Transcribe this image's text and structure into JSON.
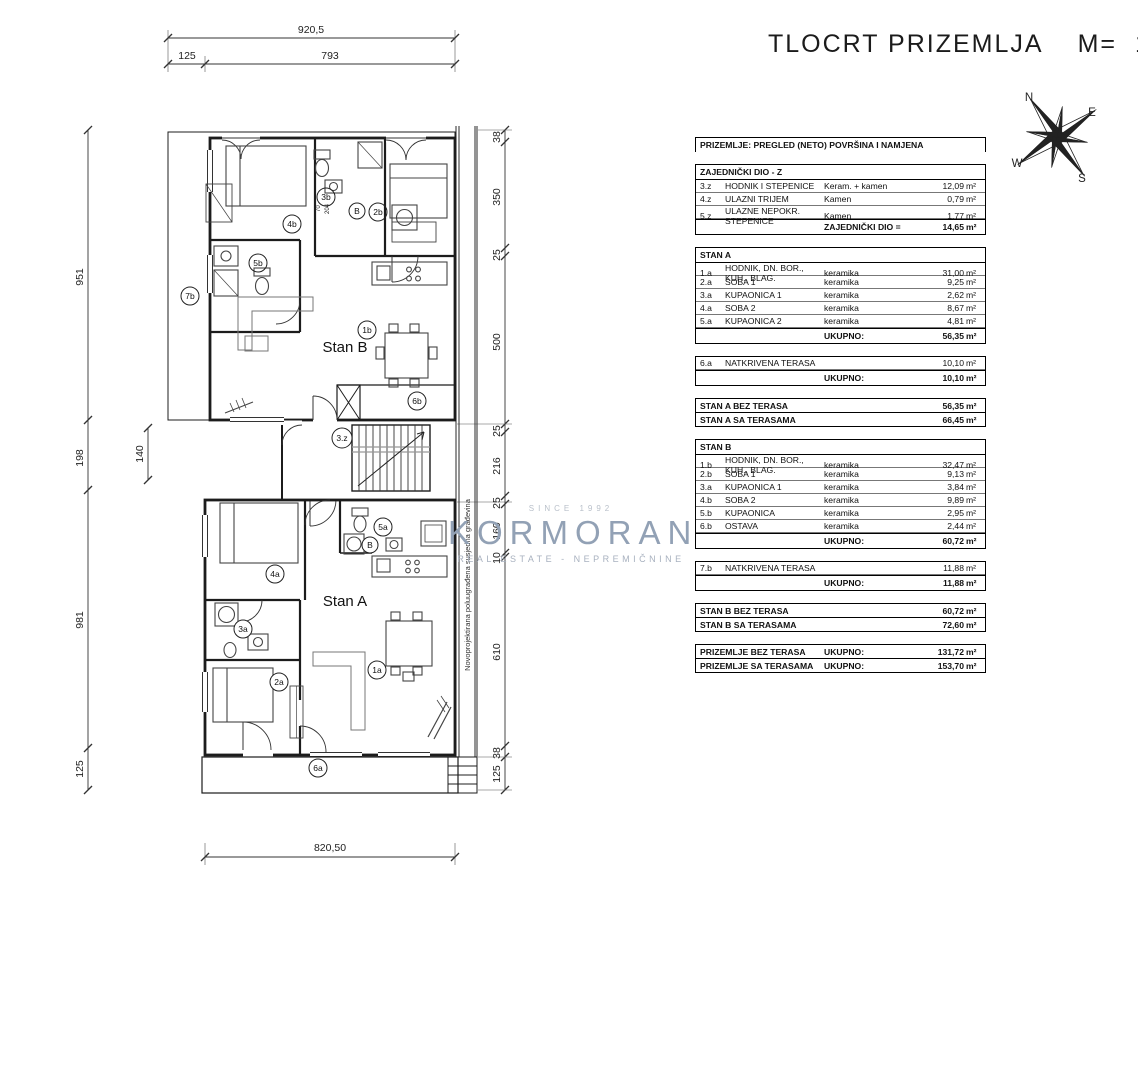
{
  "title": {
    "text": "TLOCRT PRIZEMLJA",
    "scale_label": "M=",
    "scale_value": "1:100"
  },
  "compass": {
    "n": "N",
    "e": "E",
    "s": "S",
    "w": "W"
  },
  "watermark": {
    "since": "SINCE 1992",
    "name": "KORMORAN",
    "subtitle": "REAL ESTATE - NEPREMIČNINE"
  },
  "plan": {
    "labels": {
      "stan_a": "Stan A",
      "stan_b": "Stan B",
      "side_note": "Novoprojektirana poluugrađena susjedna građevina"
    },
    "tags": {
      "t7b": "7b",
      "t4b": "4b",
      "t3b": "3b",
      "tB1": "B",
      "t2b": "2b",
      "t5b": "5b",
      "t1b": "1b",
      "t6b": "6b",
      "t3z": "3.z",
      "t4a": "4a",
      "t5a": "5a",
      "tB2": "B",
      "t3a": "3a",
      "t2a": "2a",
      "t1a": "1a",
      "t6a": "6a"
    },
    "inner_dims": {
      "d1": "70",
      "d2": "204"
    },
    "dims": {
      "top_total": "920,5",
      "top_left": "125",
      "top_right": "793",
      "bottom_total": "820,50",
      "left_1": "951",
      "left_2": "198",
      "left_2_inner": "140",
      "left_3": "981",
      "left_4": "125",
      "right_1": "38",
      "right_2": "350",
      "right_3": "25",
      "right_4": "500",
      "right_5": "25",
      "right_6": "216",
      "right_7": "25",
      "right_8": "160",
      "right_9": "10",
      "right_10": "610",
      "right_11": "38",
      "right_12": "125"
    }
  },
  "table": {
    "title": "PRIZEMLJE: PREGLED (NETO) POVRŠINA I NAMJENA",
    "unit": "m²",
    "sections": [
      {
        "header": "ZAJEDNIČKI DIO - Z",
        "rows": [
          {
            "code": "3.z",
            "name": "HODNIK I STEPENICE",
            "material": "Keram. + kamen",
            "value": "12,09"
          },
          {
            "code": "4.z",
            "name": "ULAZNI TRIJEM",
            "material": "Kamen",
            "value": "0,79"
          },
          {
            "code": "5.z",
            "name": "ULAZNE NEPOKR. STEPENICE",
            "material": "Kamen",
            "value": "1,77"
          }
        ],
        "total": {
          "label": "ZAJEDNIČKI DIO =",
          "value": "14,65"
        }
      },
      {
        "header": "STAN A",
        "rows": [
          {
            "code": "1.a",
            "name": "HODNIK, DN. BOR., KUH., BLAG.",
            "material": "keramika",
            "value": "31,00"
          },
          {
            "code": "2.a",
            "name": "SOBA 1",
            "material": "keramika",
            "value": "9,25"
          },
          {
            "code": "3.a",
            "name": "KUPAONICA 1",
            "material": "keramika",
            "value": "2,62"
          },
          {
            "code": "4.a",
            "name": "SOBA 2",
            "material": "keramika",
            "value": "8,67"
          },
          {
            "code": "5.a",
            "name": "KUPAONICA 2",
            "material": "keramika",
            "value": "4,81"
          }
        ],
        "total": {
          "label": "UKUPNO:",
          "value": "56,35"
        }
      },
      {
        "rows": [
          {
            "code": "6.a",
            "name": "NATKRIVENA TERASA",
            "material": "",
            "value": "10,10"
          }
        ],
        "total": {
          "label": "UKUPNO:",
          "value": "10,10"
        }
      },
      {
        "summary": [
          {
            "label": "STAN A BEZ TERASA",
            "mid": "",
            "value": "56,35"
          },
          {
            "label": "STAN A SA TERASAMA",
            "mid": "",
            "value": "66,45"
          }
        ]
      },
      {
        "header": "STAN B",
        "rows": [
          {
            "code": "1.b",
            "name": "HODNIK, DN. BOR., KUH., BLAG.",
            "material": "keramika",
            "value": "32,47"
          },
          {
            "code": "2.b",
            "name": "SOBA 1",
            "material": "keramika",
            "value": "9,13"
          },
          {
            "code": "3.a",
            "name": "KUPAONICA 1",
            "material": "keramika",
            "value": "3,84"
          },
          {
            "code": "4.b",
            "name": "SOBA 2",
            "material": "keramika",
            "value": "9,89"
          },
          {
            "code": "5.b",
            "name": "KUPAONICA",
            "material": "keramika",
            "value": "2,95"
          },
          {
            "code": "6.b",
            "name": "OSTAVA",
            "material": "keramika",
            "value": "2,44"
          }
        ],
        "total": {
          "label": "UKUPNO:",
          "value": "60,72"
        }
      },
      {
        "rows": [
          {
            "code": "7.b",
            "name": "NATKRIVENA TERASA",
            "material": "",
            "value": "11,88"
          }
        ],
        "total": {
          "label": "UKUPNO:",
          "value": "11,88"
        }
      },
      {
        "summary": [
          {
            "label": "STAN B BEZ TERASA",
            "mid": "",
            "value": "60,72"
          },
          {
            "label": "STAN B SA TERASAMA",
            "mid": "",
            "value": "72,60"
          }
        ]
      },
      {
        "summary": [
          {
            "label": "PRIZEMLJE BEZ TERASA",
            "mid": "UKUPNO:",
            "value": "131,72"
          },
          {
            "label": "PRIZEMLJE SA TERASAMA",
            "mid": "UKUPNO:",
            "value": "153,70"
          }
        ]
      }
    ]
  }
}
